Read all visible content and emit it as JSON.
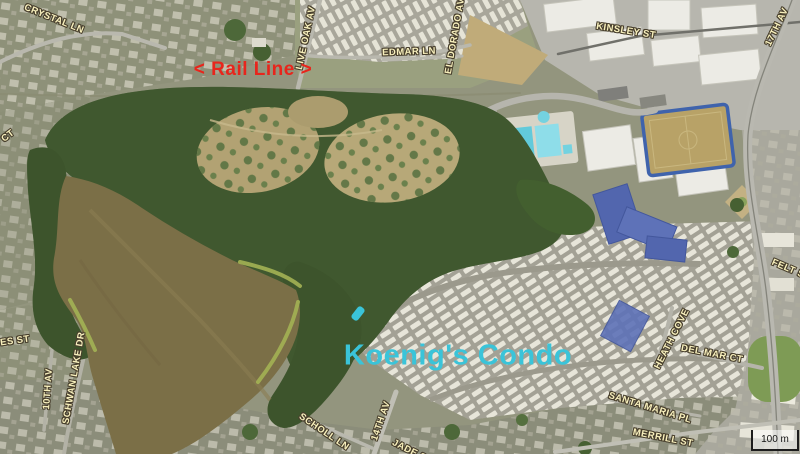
{
  "map": {
    "type": "aerial-satellite-view",
    "scale_bar": {
      "label": "100 m"
    },
    "annotations": {
      "rail_line": {
        "text": "< Rail Line >",
        "color": "#e8251c"
      },
      "koenigs_condo": {
        "text": "Koenig's Condo",
        "color": "#3ac4d9"
      }
    },
    "marker_color": "#3ac4d9",
    "label_style": {
      "fill": "#f8f0bd",
      "outline": "#483f2d"
    },
    "street_labels": [
      "CRYSTAL LN",
      "LIVE OAK AV",
      "EDMAR LN",
      "EL DORADO AV",
      "KINSLEY ST",
      "17TH AV",
      "CT",
      "ES ST",
      "10TH AV",
      "SCHWAN LAKE DR",
      "SCHOLL LN",
      "14TH AV",
      "JADE ST",
      "FELT ST",
      "HEATH COVE",
      "DEL MAR CT",
      "SANTA MARIA PL",
      "MERRILL ST"
    ],
    "terrain_colors": {
      "forest": "#40582f",
      "lagoon_water": "#7b6f47",
      "meadow": "#b2a273",
      "marsh_edge": "#a3b254",
      "pool_water": "#6fcede",
      "school_roof": "#5266ae",
      "soccer_field_trim": "#3f63ac"
    }
  }
}
